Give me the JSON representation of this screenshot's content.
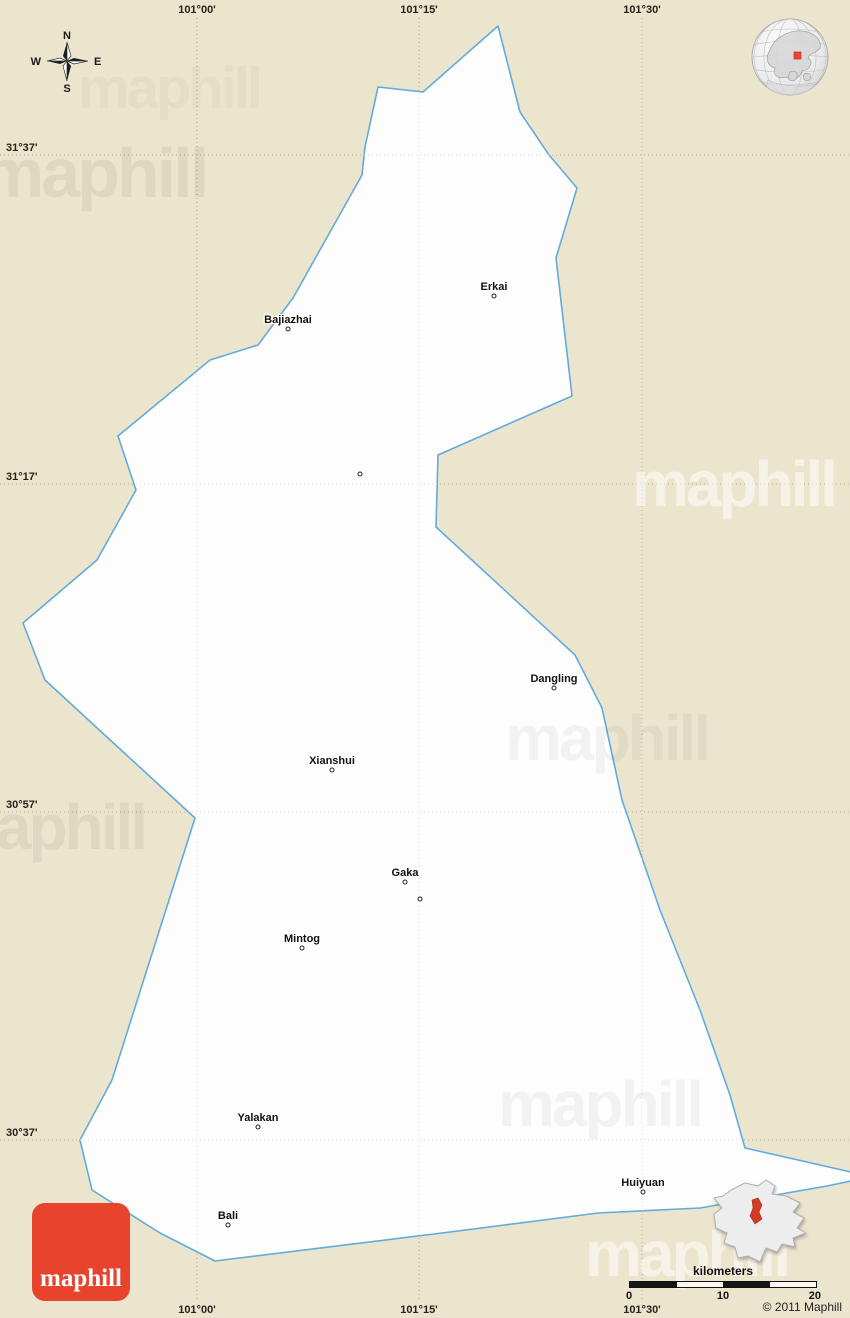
{
  "map": {
    "boundary_points": "498,26 520,112 549,155 577,188 562,238 556,258 572,396 438,455 436,527 575,655 602,708 622,800 660,910 700,1010 730,1095 745,1148 851,1172 851,1181 827,1186 700,1208 598,1213 450,1232 215,1261 160,1233 92,1190 80,1140 112,1080 195,818 45,680 23,623 97,560 136,490 118,436 210,360 258,345 293,298 362,175 365,147 378,87 423,92",
    "colors": {
      "background": "#ece5ce",
      "region_fill": "#fdfdfd",
      "boundary": "#63aadd",
      "grid_on_background": "#b3aa90",
      "grid_on_region": "#e3e0d7"
    }
  },
  "compass": {
    "north": "N",
    "south": "S",
    "east": "E",
    "west": "W"
  },
  "grid": {
    "meridians": [
      {
        "label": "101°00'",
        "x": 197
      },
      {
        "label": "101°15'",
        "x": 419
      },
      {
        "label": "101°30'",
        "x": 642
      }
    ],
    "parallels": [
      {
        "label": "31°37'",
        "y": 155
      },
      {
        "label": "31°17'",
        "y": 484
      },
      {
        "label": "30°57'",
        "y": 812
      },
      {
        "label": "30°37'",
        "y": 1140
      }
    ]
  },
  "places": [
    {
      "name": "Erkai",
      "x": 494,
      "y": 287
    },
    {
      "name": "Bajiazhai",
      "x": 288,
      "y": 320
    },
    {
      "name": "Dangling",
      "x": 554,
      "y": 679
    },
    {
      "name": "Xianshui",
      "x": 332,
      "y": 761
    },
    {
      "name": "Gaka",
      "x": 405,
      "y": 873
    },
    {
      "name": "Mintog",
      "x": 302,
      "y": 939
    },
    {
      "name": "Yalakan",
      "x": 258,
      "y": 1118
    },
    {
      "name": "Bali",
      "x": 228,
      "y": 1216
    },
    {
      "name": "Huiyuan",
      "x": 643,
      "y": 1183
    }
  ],
  "unlabeled_markers": [
    {
      "x": 360,
      "y": 474
    },
    {
      "x": 420,
      "y": 899
    }
  ],
  "scale_bar": {
    "title": "kilometers",
    "tick_labels": [
      "0",
      "10",
      "20"
    ],
    "segments": 4
  },
  "copyright": "© 2011 Maphill",
  "logo": {
    "label": "maphill",
    "background": "#e8432d"
  },
  "watermark": {
    "text": "maphill"
  },
  "inset": {
    "highlight_color": "#d43b24"
  },
  "globe": {
    "marker_color": "#e8472e"
  }
}
